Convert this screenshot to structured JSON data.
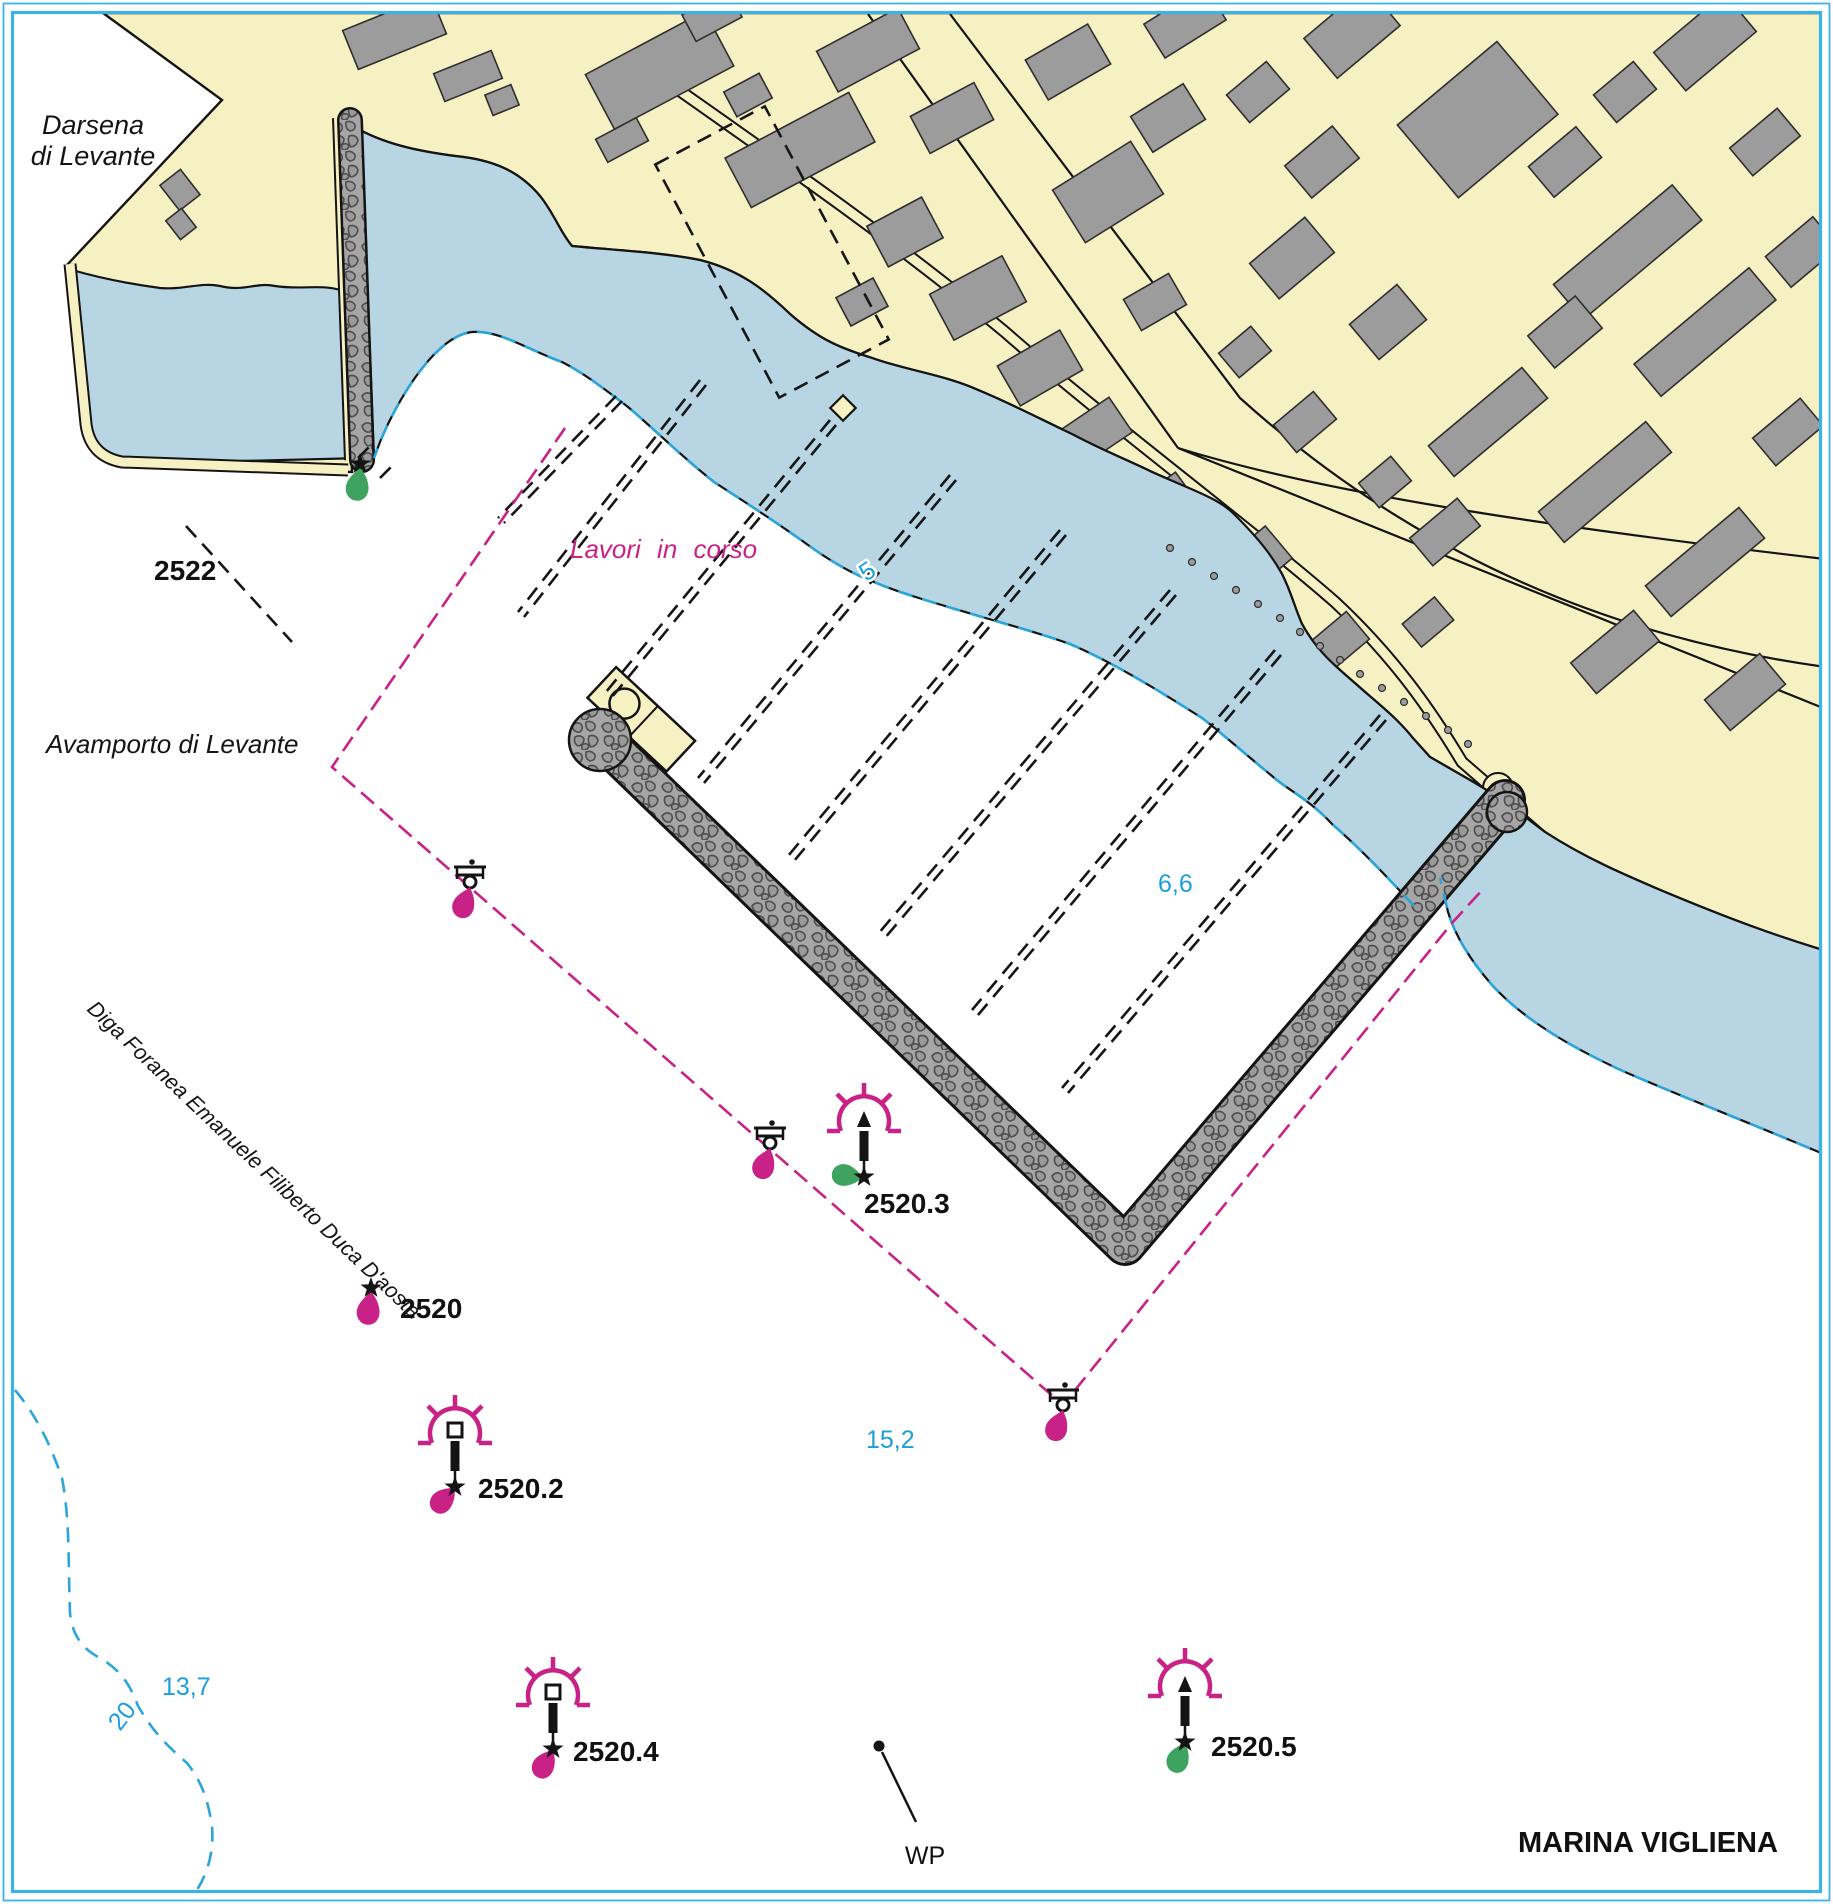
{
  "chart": {
    "title": "MARINA VIGLIENA",
    "works_note": "Lavori in corso",
    "waypoint_label": "WP",
    "place_names": {
      "darsena_line1": "Darsena",
      "darsena_line2": "di Levante",
      "avamporto": "Avamporto di Levante",
      "diga_foranea": "Diga Foranea Emanuele Filiberto Duca D'aosta"
    },
    "navigation_aids": [
      {
        "number": "2522",
        "kind": "breakwater-head light",
        "flare_color": "green"
      },
      {
        "number": "2520",
        "kind": "diga-foranea head light",
        "flare_color": "magenta"
      },
      {
        "number": "2520.2",
        "kind": "lighted buoy, square topmark",
        "flare_color": "magenta"
      },
      {
        "number": "2520.3",
        "kind": "lighted buoy, cone topmark",
        "flare_color": "green"
      },
      {
        "number": "2520.4",
        "kind": "lighted buoy, square topmark",
        "flare_color": "magenta"
      },
      {
        "number": "2520.5",
        "kind": "lighted buoy, cone topmark",
        "flare_color": "green"
      }
    ],
    "soundings": [
      {
        "value": "5",
        "type": "depth contour label"
      },
      {
        "value": "6,6",
        "type": "sounding"
      },
      {
        "value": "15,2",
        "type": "sounding"
      },
      {
        "value": "13,7",
        "type": "sounding"
      },
      {
        "value": "20",
        "type": "depth contour label"
      }
    ],
    "colors": {
      "land": "#f6f1c3",
      "shallow_water": "#b7d5e2",
      "deep_water": "#ffffff",
      "contour_cyan": "#2aa5dc",
      "frame_cyan": "#3bb3e6",
      "magenta": "#c92286",
      "green_flare": "#3da35e",
      "building_gray": "#9c9c9c",
      "rubble_gray": "#a6a6a6"
    }
  }
}
